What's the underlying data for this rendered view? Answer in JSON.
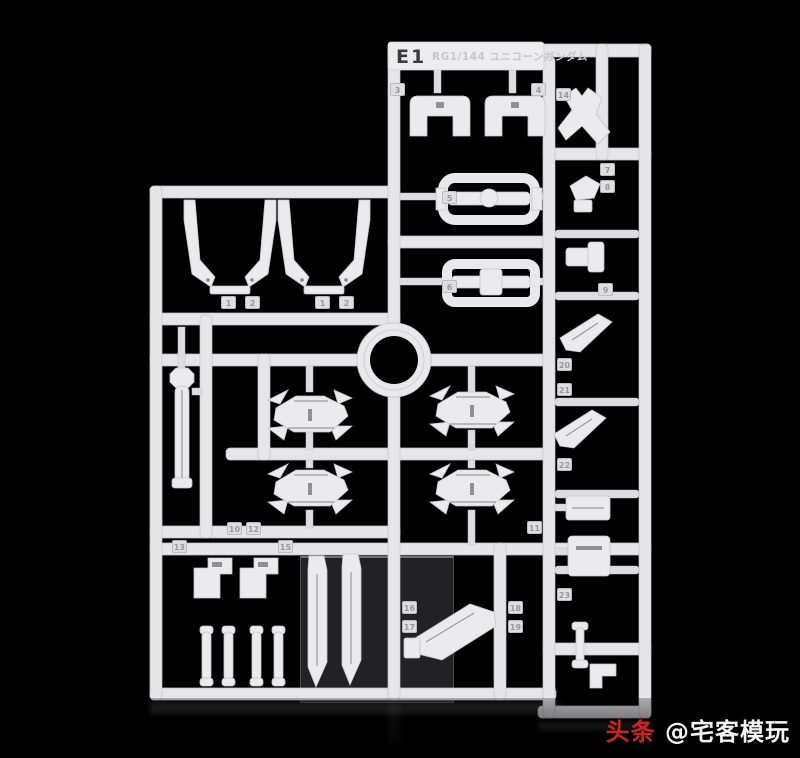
{
  "photo": {
    "background_color": "#000000",
    "subject": "white-plastic-model-kit-runner"
  },
  "sprue": {
    "runner_code": "E1",
    "runner_title": "RG1/144 ユニコーンガンダム",
    "plastic_color": "#e8e8ea",
    "part_tags": [
      {
        "num": "1",
        "x": 221,
        "y": 296
      },
      {
        "num": "2",
        "x": 245,
        "y": 296
      },
      {
        "num": "1",
        "x": 315,
        "y": 296
      },
      {
        "num": "2",
        "x": 339,
        "y": 296
      },
      {
        "num": "3",
        "x": 390,
        "y": 83
      },
      {
        "num": "4",
        "x": 531,
        "y": 83
      },
      {
        "num": "5",
        "x": 442,
        "y": 191
      },
      {
        "num": "6",
        "x": 442,
        "y": 280
      },
      {
        "num": "7",
        "x": 600,
        "y": 163
      },
      {
        "num": "8",
        "x": 600,
        "y": 180
      },
      {
        "num": "9",
        "x": 598,
        "y": 283
      },
      {
        "num": "14",
        "x": 556,
        "y": 88
      },
      {
        "num": "10",
        "x": 227,
        "y": 522
      },
      {
        "num": "12",
        "x": 246,
        "y": 522
      },
      {
        "num": "11",
        "x": 527,
        "y": 521
      },
      {
        "num": "13",
        "x": 172,
        "y": 540
      },
      {
        "num": "15",
        "x": 278,
        "y": 540
      },
      {
        "num": "16",
        "x": 402,
        "y": 601
      },
      {
        "num": "17",
        "x": 402,
        "y": 620
      },
      {
        "num": "18",
        "x": 508,
        "y": 601
      },
      {
        "num": "19",
        "x": 508,
        "y": 620
      },
      {
        "num": "20",
        "x": 557,
        "y": 358
      },
      {
        "num": "21",
        "x": 557,
        "y": 383
      },
      {
        "num": "22",
        "x": 557,
        "y": 458
      },
      {
        "num": "23",
        "x": 557,
        "y": 588
      }
    ]
  },
  "watermark": {
    "brand": "头条",
    "account": "@宅客模玩",
    "brand_color": "#cd2420",
    "account_color": "#f2f2f2"
  }
}
